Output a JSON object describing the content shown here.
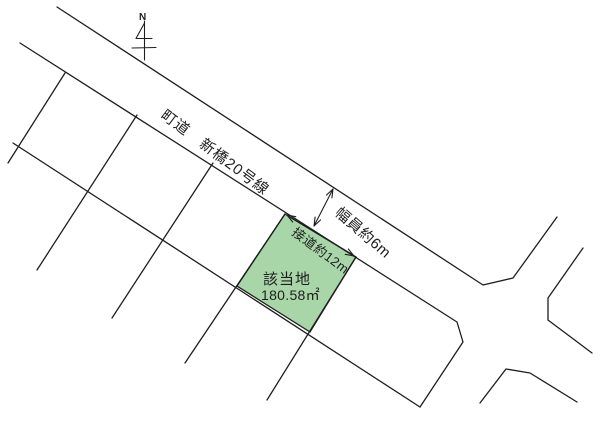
{
  "map": {
    "north_label": "N",
    "road_name": "町道　新橋20号線",
    "road_width_label": "幅員約6m",
    "frontage_label": "接道約12m",
    "plot_name": "該当地",
    "plot_area": "180.58㎡",
    "plot_fill_color": "#a8d6a8",
    "line_color": "#1e1e1e",
    "background_color": "#ffffff"
  }
}
